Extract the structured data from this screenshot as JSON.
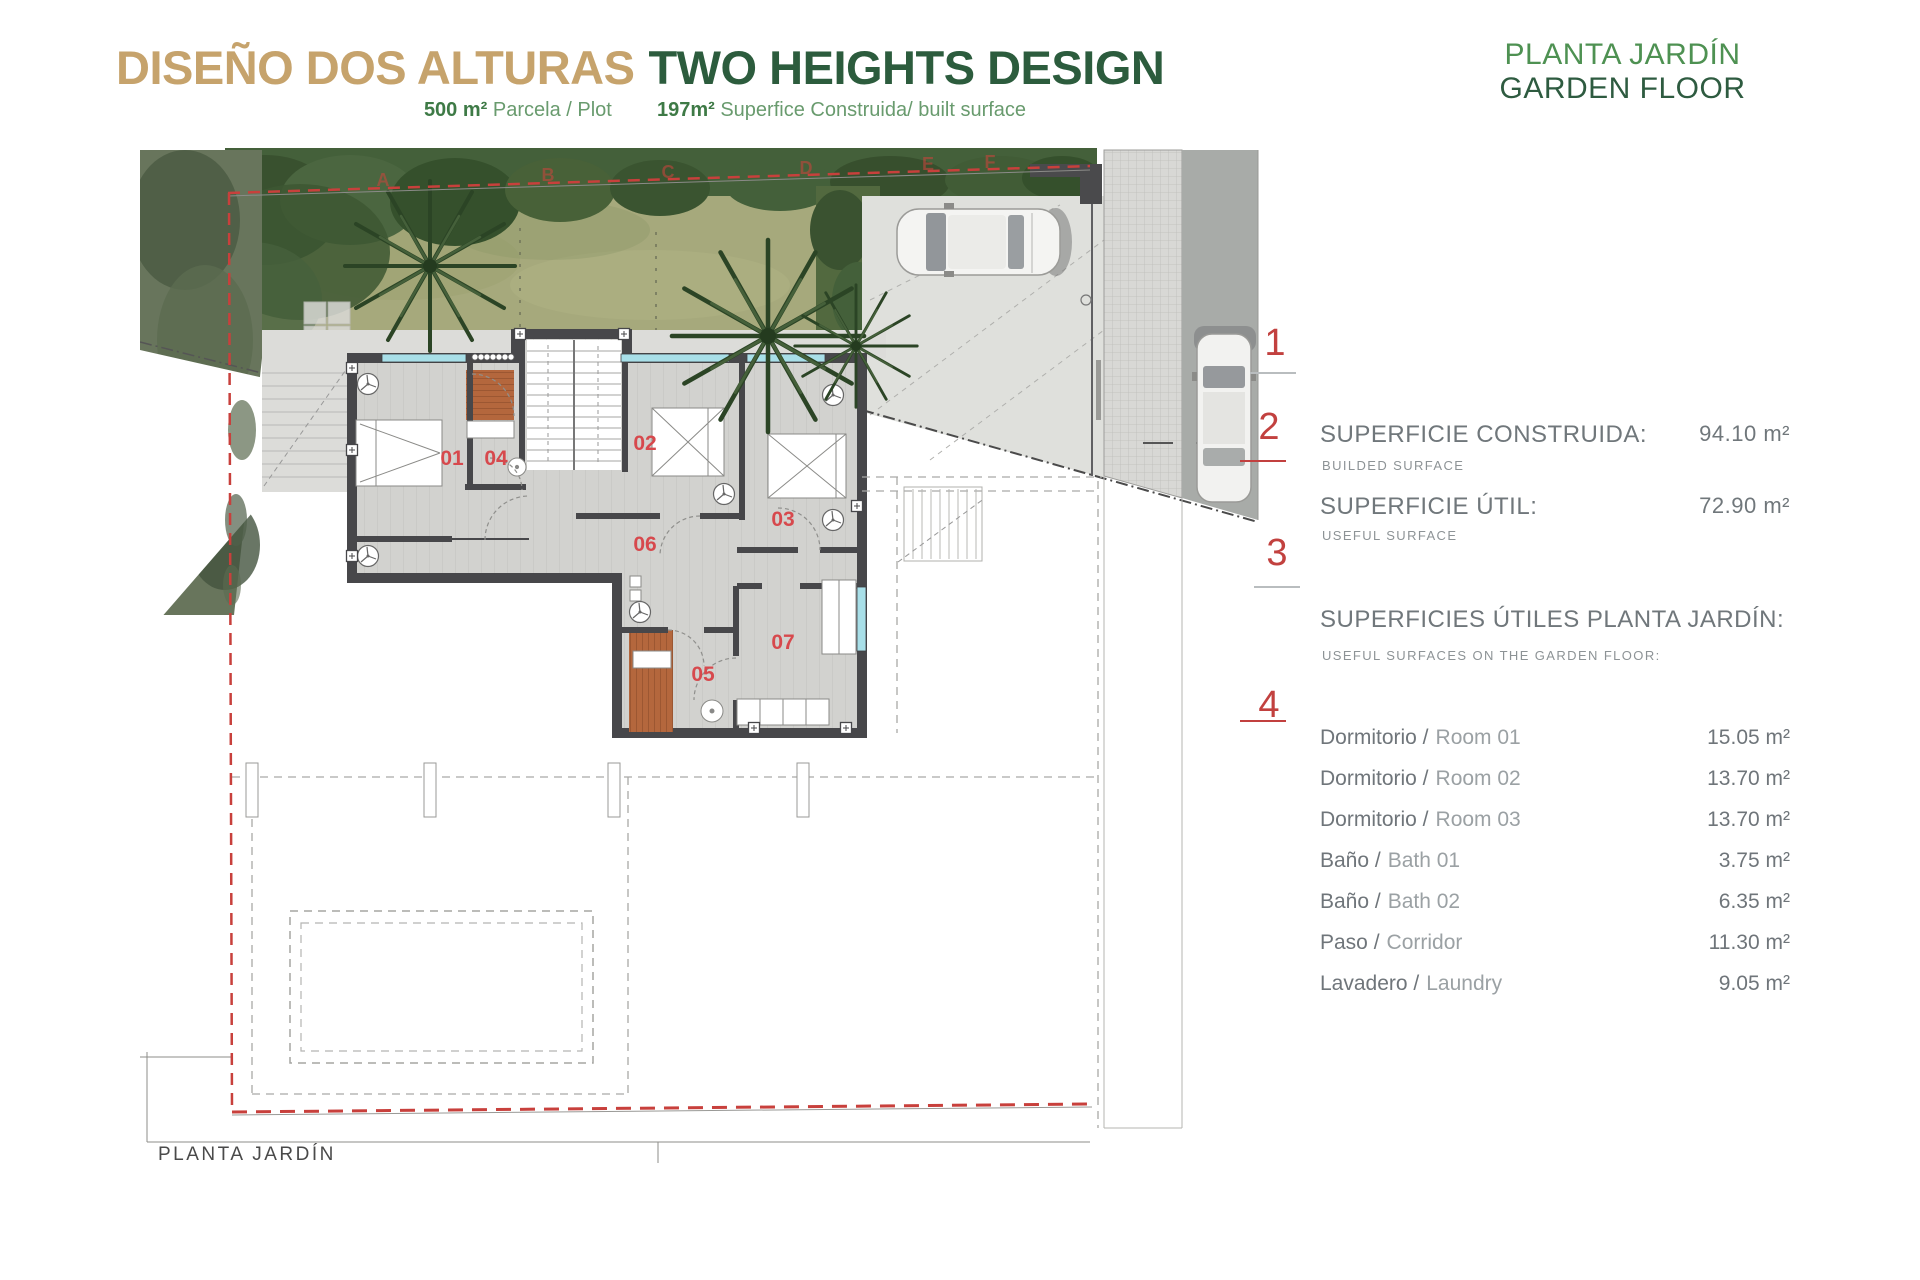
{
  "header": {
    "title_es": "DISEÑO DOS ALTURAS",
    "title_en": "TWO HEIGHTS DESIGN",
    "subtitle": {
      "plot_value": "500 m²",
      "plot_label": "Parcela / Plot",
      "built_value": "197m²",
      "built_label": "Superfice Construida/ built surface"
    },
    "floor_es": "PLANTA JARDÍN",
    "floor_en": "GARDEN FLOOR"
  },
  "panel": {
    "markers": [
      "1",
      "2",
      "3",
      "4"
    ],
    "built": {
      "label": "SUPERFICIE CONSTRUIDA:",
      "sub": "BUILDED SURFACE",
      "value": "94.10 m²"
    },
    "useful": {
      "label": "SUPERFICIE ÚTIL:",
      "sub": "USEFUL SURFACE",
      "value": "72.90 m²"
    },
    "list_heading": {
      "label": "SUPERFICIES ÚTILES PLANTA JARDÍN:",
      "sub": "USEFUL SURFACES ON THE GARDEN FLOOR:"
    },
    "rooms": [
      {
        "es": "Dormitorio /",
        "en": "Room 01",
        "value": "15.05 m²"
      },
      {
        "es": "Dormitorio /",
        "en": "Room 02",
        "value": "13.70 m²"
      },
      {
        "es": "Dormitorio /",
        "en": "Room 03",
        "value": "13.70 m²"
      },
      {
        "es": "Baño /",
        "en": "Bath 01",
        "value": "3.75 m²"
      },
      {
        "es": "Baño /",
        "en": "Bath 02",
        "value": "6.35 m²"
      },
      {
        "es": "Paso /",
        "en": "Corridor",
        "value": "11.30 m²"
      },
      {
        "es": "Lavadero /",
        "en": "Laundry",
        "value": "9.05 m²"
      }
    ]
  },
  "plan": {
    "caption": "PLANTA JARDÍN",
    "room_labels": [
      "01",
      "02",
      "03",
      "04",
      "05",
      "06",
      "07"
    ],
    "boundary_letters": [
      "A",
      "B",
      "C",
      "D",
      "E",
      "F"
    ]
  },
  "colors": {
    "title_tan": "#c6a36c",
    "title_green": "#2c5c3d",
    "floor_green": "#4e9152",
    "panel_gray": "#70777b",
    "accent_red": "#c2413f",
    "boundary_red": "#c8403c",
    "wall_dark": "#47474a",
    "wood": "#b4673d",
    "lawn": "#a6a97c"
  }
}
